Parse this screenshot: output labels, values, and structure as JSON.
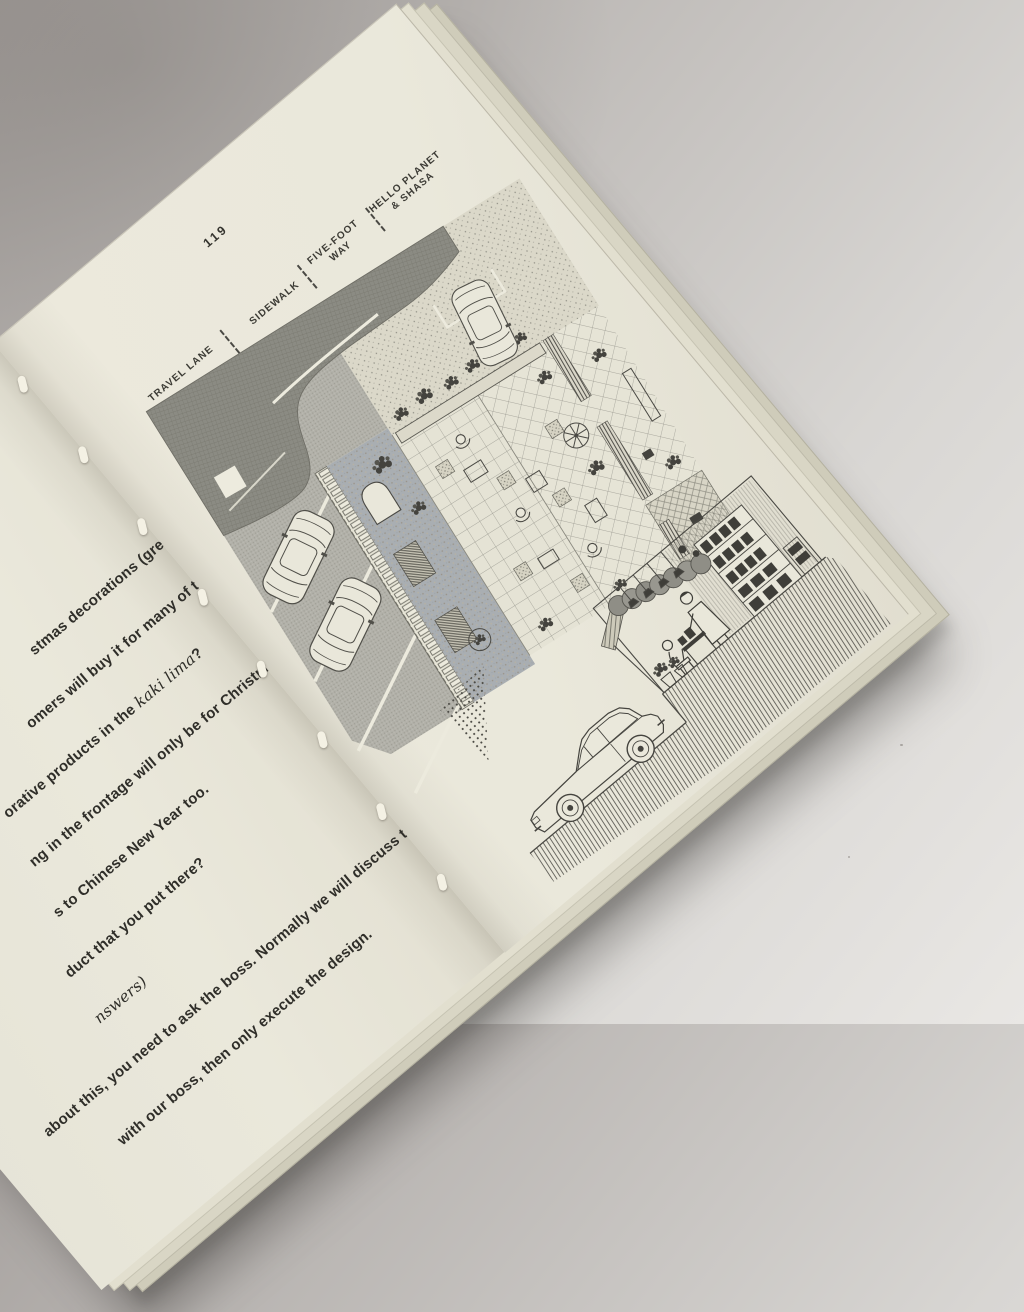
{
  "colors": {
    "backdrop": "#c6c3c0",
    "paper": "#eae8db",
    "ink": "#2f2e29",
    "print_dark": "#4a4944",
    "print_mid": "#8f8e86",
    "asphalt": "#b3b2aa",
    "walkway_bluegray": "#a9aeb2"
  },
  "right_page": {
    "page_number": "119",
    "figure_labels": [
      "TRAVEL LANE",
      "SIDEWALK",
      "FIVE-FOOT\nWAY",
      "HELLO PLANET\n& SHASA"
    ]
  },
  "left_page": {
    "lines": [
      {
        "pre": "stmas decorations (green",
        "italic": "",
        "post": ""
      },
      {
        "pre": "omers will buy it for many of the",
        "italic": "",
        "post": ""
      },
      {
        "pre": "orative products in the ",
        "italic": "kaki lima",
        "post": "?"
      },
      {
        "pre": "ng in the frontage will only be for Christmas",
        "italic": "",
        "post": ""
      },
      {
        "pre": "s to Chinese New Year too.",
        "italic": "",
        "post": ""
      },
      {
        "pre": "duct that you put there?",
        "italic": "",
        "post": ""
      },
      {
        "pre": "",
        "italic": "nswers)",
        "post": ""
      },
      {
        "pre": "about this, you need to ask the boss. Normally we will discuss the",
        "italic": "",
        "post": ""
      },
      {
        "pre": "with our boss, then only execute the design.",
        "italic": "",
        "post": ""
      }
    ]
  }
}
